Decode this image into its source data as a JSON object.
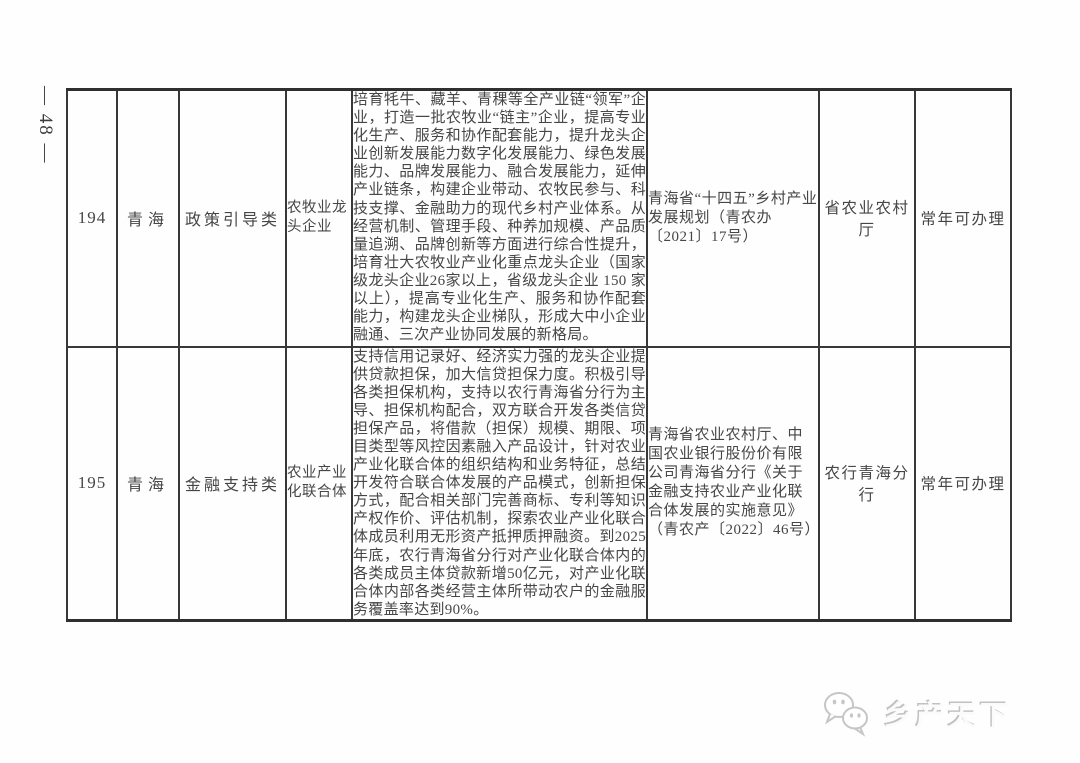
{
  "page": {
    "page_number": "— 48 —",
    "background": "#ffffff",
    "text_color": "#454545",
    "border_color": "#383838"
  },
  "table": {
    "rows": [
      {
        "index": "194",
        "province": "青海",
        "category": "政策引导类",
        "subject": "农牧业龙头企业",
        "description": "培育牦牛、藏羊、青稞等全产业链“领军”企业，打造一批农牧业“链主”企业，提高专业化生产、服务和协作配套能力，提升龙头企业创新发展能力数字化发展能力、绿色发展能力、品牌发展能力、融合发展能力，延伸产业链条，构建企业带动、农牧民参与、科技支撑、金融助力的现代乡村产业体系。从经营机制、管理手段、种养加规模、产品质量追溯、品牌创新等方面进行综合性提升，培育壮大农牧业产业化重点龙头企业（国家级龙头企业26家以上，省级龙头企业 150 家以上），提高专业化生产、服务和协作配套能力，构建龙头企业梯队，形成大中小企业融通、三次产业协同发展的新格局。",
        "policy_document": "青海省“十四五”乡村产业发展规划（青农办〔2021〕17号）",
        "department": "省农业农村厅",
        "availability": "常年可办理"
      },
      {
        "index": "195",
        "province": "青海",
        "category": "金融支持类",
        "subject": "农业产业化联合体",
        "description": "支持信用记录好、经济实力强的龙头企业提供贷款担保，加大信贷担保力度。积极引导各类担保机构，支持以农行青海省分行为主导、担保机构配合，双方联合开发各类信贷担保产品，将借款（担保）规模、期限、项目类型等风控因素融入产品设计，针对农业产业化联合体的组织结构和业务特征，总结开发符合联合体发展的产品模式，创新担保方式，配合相关部门完善商标、专利等知识产权作价、评估机制，探索农业产业化联合体成员利用无形资产抵押质押融资。到2025年底，农行青海省分行对产业化联合体内的各类成员主体贷款新增50亿元，对产业化联合体内部各类经营主体所带动农户的金融服务覆盖率达到90%。",
        "policy_document": "青海省农业农村厅、中国农业银行股份价有限公司青海省分行《关于金融支持农业产业化联合体发展的实施意见》（青农产〔2022〕46号）",
        "department": "农行青海分行",
        "availability": "常年可办理"
      }
    ]
  },
  "watermark": {
    "icon": "chat-bubbles-icon",
    "text": "乡产天下",
    "color": "#c6c6c6"
  }
}
